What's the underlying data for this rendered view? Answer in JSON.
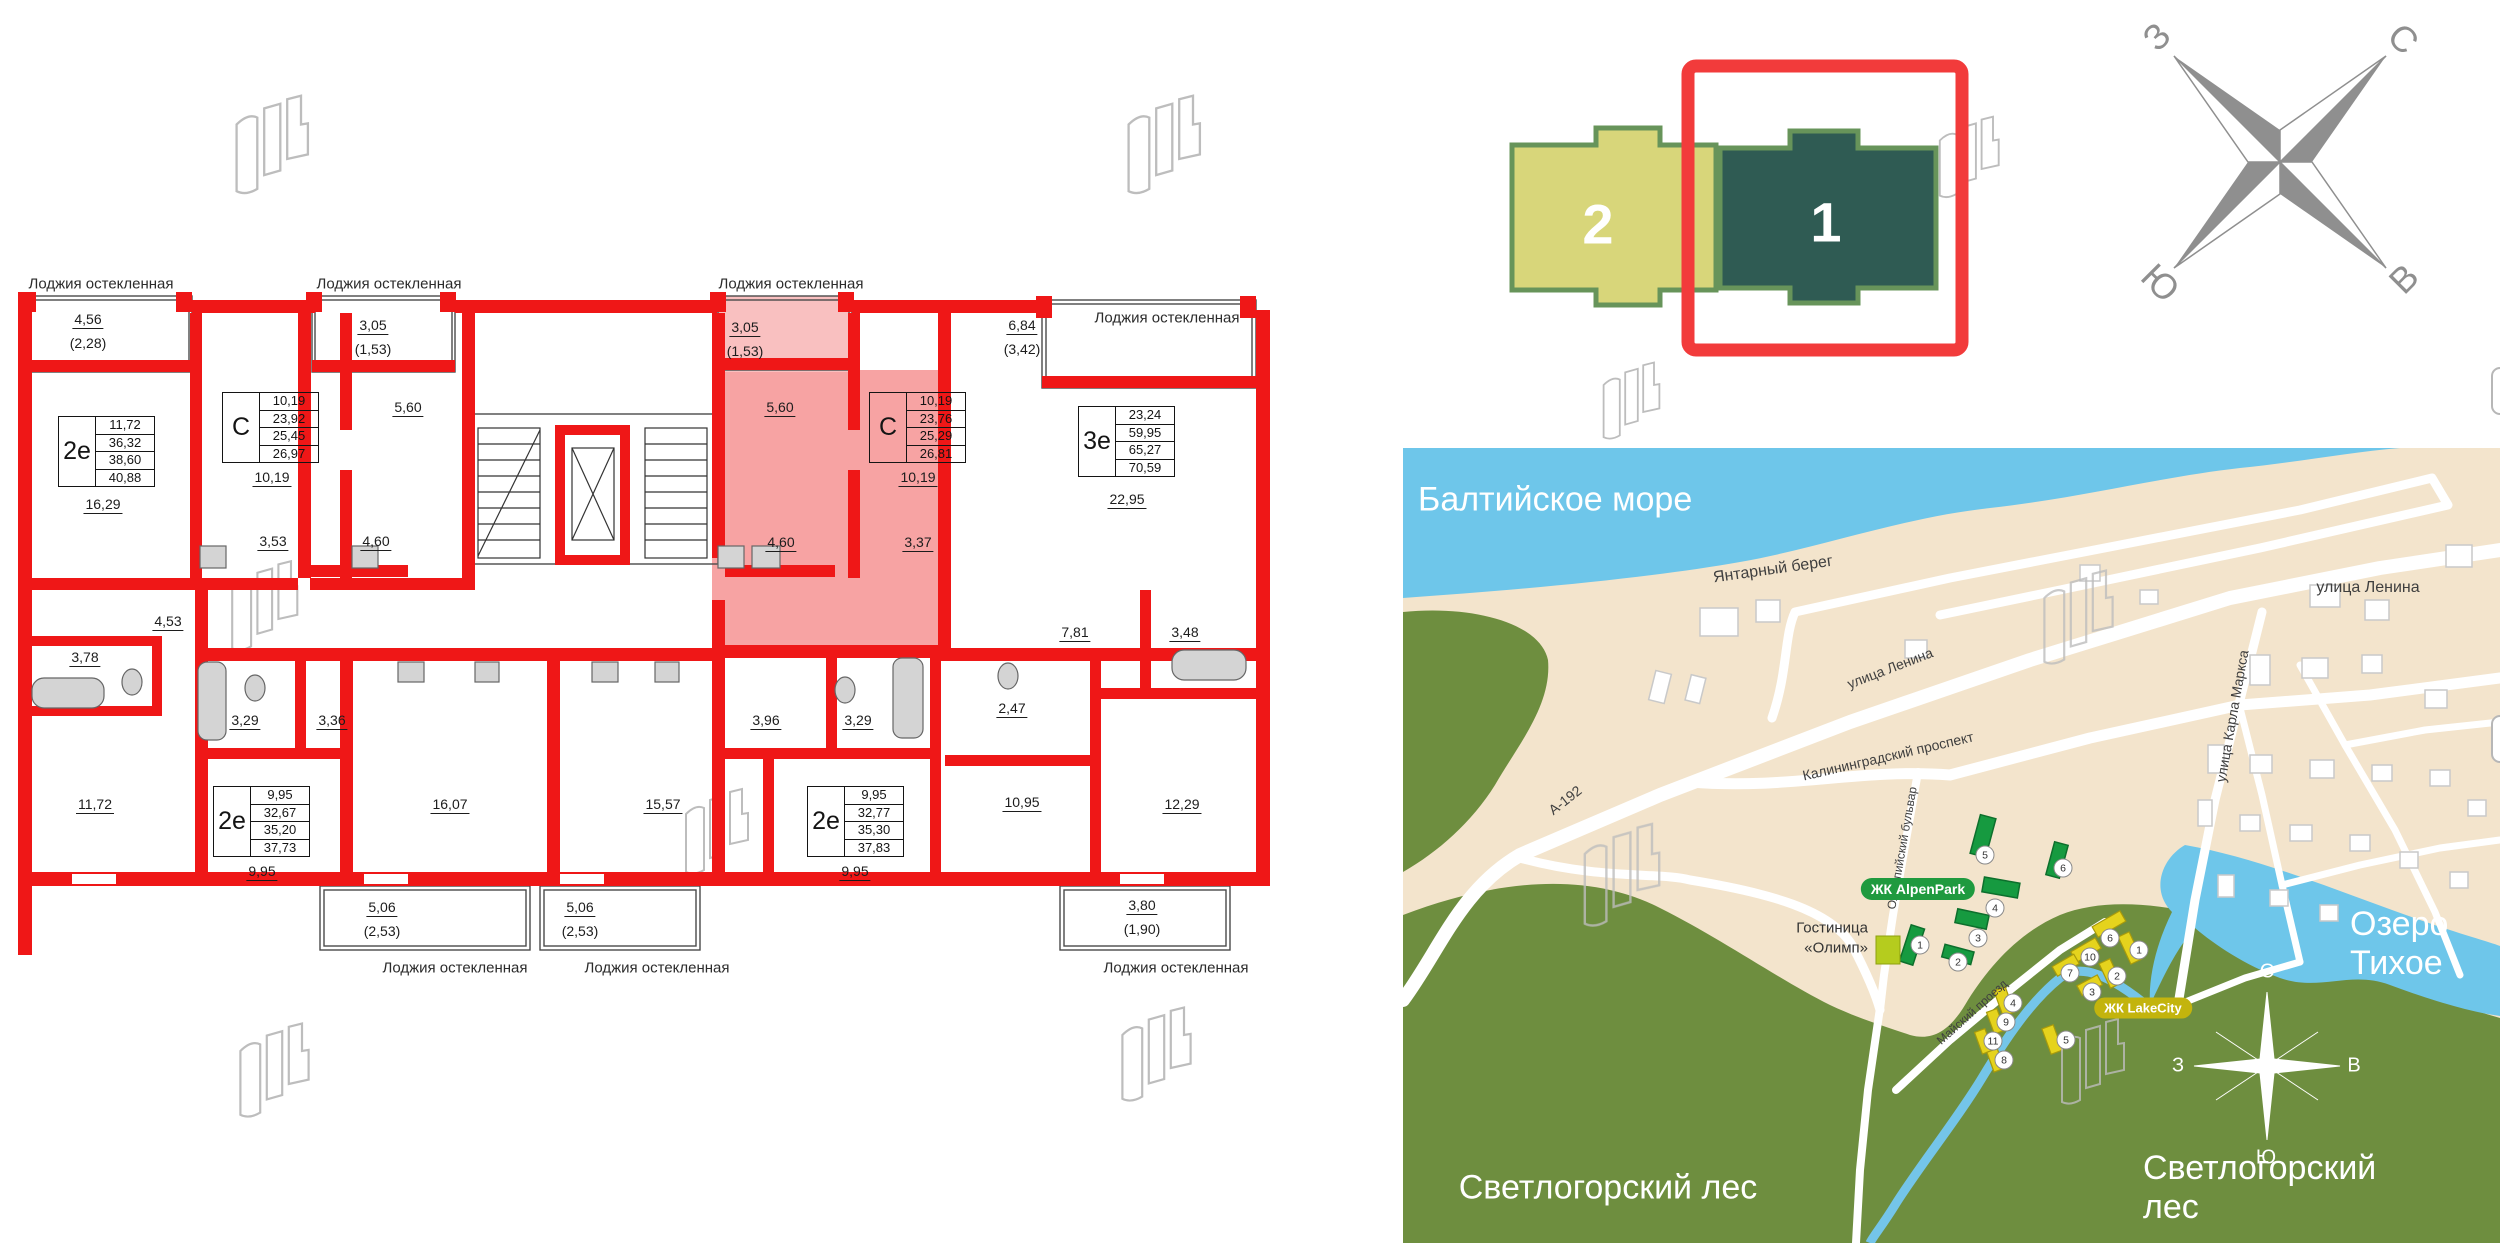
{
  "floorplan": {
    "loggia_labels": [
      "Лоджия остекленная",
      "Лоджия остекленная",
      "Лоджия остекленная",
      "Лоджия остекленная",
      "Лоджия остекленная",
      "Лоджия остекленная",
      "Лоджия остекленная"
    ],
    "info_boxes": [
      {
        "type": "2е",
        "values": [
          "11,72",
          "36,32",
          "38,60",
          "40,88"
        ]
      },
      {
        "type": "С",
        "values": [
          "10,19",
          "23,92",
          "25,45",
          "26,97"
        ]
      },
      {
        "type": "С",
        "values": [
          "10,19",
          "23,76",
          "25,29",
          "26,81"
        ]
      },
      {
        "type": "3е",
        "values": [
          "23,24",
          "59,95",
          "65,27",
          "70,59"
        ]
      },
      {
        "type": "2е",
        "values": [
          "9,95",
          "32,67",
          "35,20",
          "37,73"
        ]
      },
      {
        "type": "2е",
        "values": [
          "9,95",
          "32,77",
          "35,30",
          "37,83"
        ]
      }
    ],
    "areas": [
      "16,29",
      "10,19",
      "3,53",
      "4,60",
      "5,60",
      "3,05",
      "(1,53)",
      "4,56",
      "(2,28)",
      "3,05",
      "(1,53)",
      "5,60",
      "10,19",
      "4,60",
      "3,37",
      "6,84",
      "(3,42)",
      "22,95",
      "4,53",
      "3,78",
      "11,72",
      "9,95",
      "3,29",
      "3,36",
      "16,07",
      "15,57",
      "5,06",
      "(2,53)",
      "5,06",
      "(2,53)",
      "3,96",
      "3,29",
      "9,95",
      "2,47",
      "10,95",
      "7,81",
      "3,48",
      "12,29",
      "3,80",
      "(1,90)"
    ],
    "highlight_color": "#f7a3a3",
    "wall_color": "#ef1717"
  },
  "section_selector": {
    "sections": [
      {
        "number": "2",
        "fill": "#d8d67a"
      },
      {
        "number": "1",
        "fill": "#2f5b53",
        "selected": true
      }
    ],
    "frame_color": "#f23b3b"
  },
  "compass_main": {
    "west": "З",
    "north": "С",
    "south": "Ю",
    "east": "В"
  },
  "map": {
    "sea_label": "Балтийское море",
    "beach_label": "Янтарный берег",
    "lake_label": "Озеро Тихое",
    "forest_label_left": "Светлогорский лес",
    "forest_label_right": "Светлогорский лес",
    "streets": {
      "a192": "А-192",
      "lenina_left": "улица Ленина",
      "lenina_right": "улица Ленина",
      "kaliningradsky": "Калининградский проспект",
      "karla_marksa": "улица Карла Маркса",
      "olimpiysky": "Олимпийский бульвар",
      "maysky": "Майский проезд"
    },
    "alpenpark_badge": "ЖК AlpenPark",
    "lakecity_badge": "ЖК LakeCity",
    "hotel_line1": "Гостиница",
    "hotel_line2": "«Олимп»",
    "green_numbers": [
      "1",
      "2",
      "3",
      "4",
      "5",
      "6"
    ],
    "yellow_numbers": [
      "1",
      "2",
      "3",
      "4",
      "5",
      "6",
      "7",
      "8",
      "9",
      "10",
      "11"
    ],
    "mini_compass": {
      "north": "С",
      "south": "Ю",
      "west": "З",
      "east": "В"
    },
    "colors": {
      "sea": "#6ec6ea",
      "sand": "#f3e4cc",
      "forest": "#6e8e3f",
      "green_bld": "#169a40",
      "yellow_bld": "#e5d31d"
    }
  }
}
